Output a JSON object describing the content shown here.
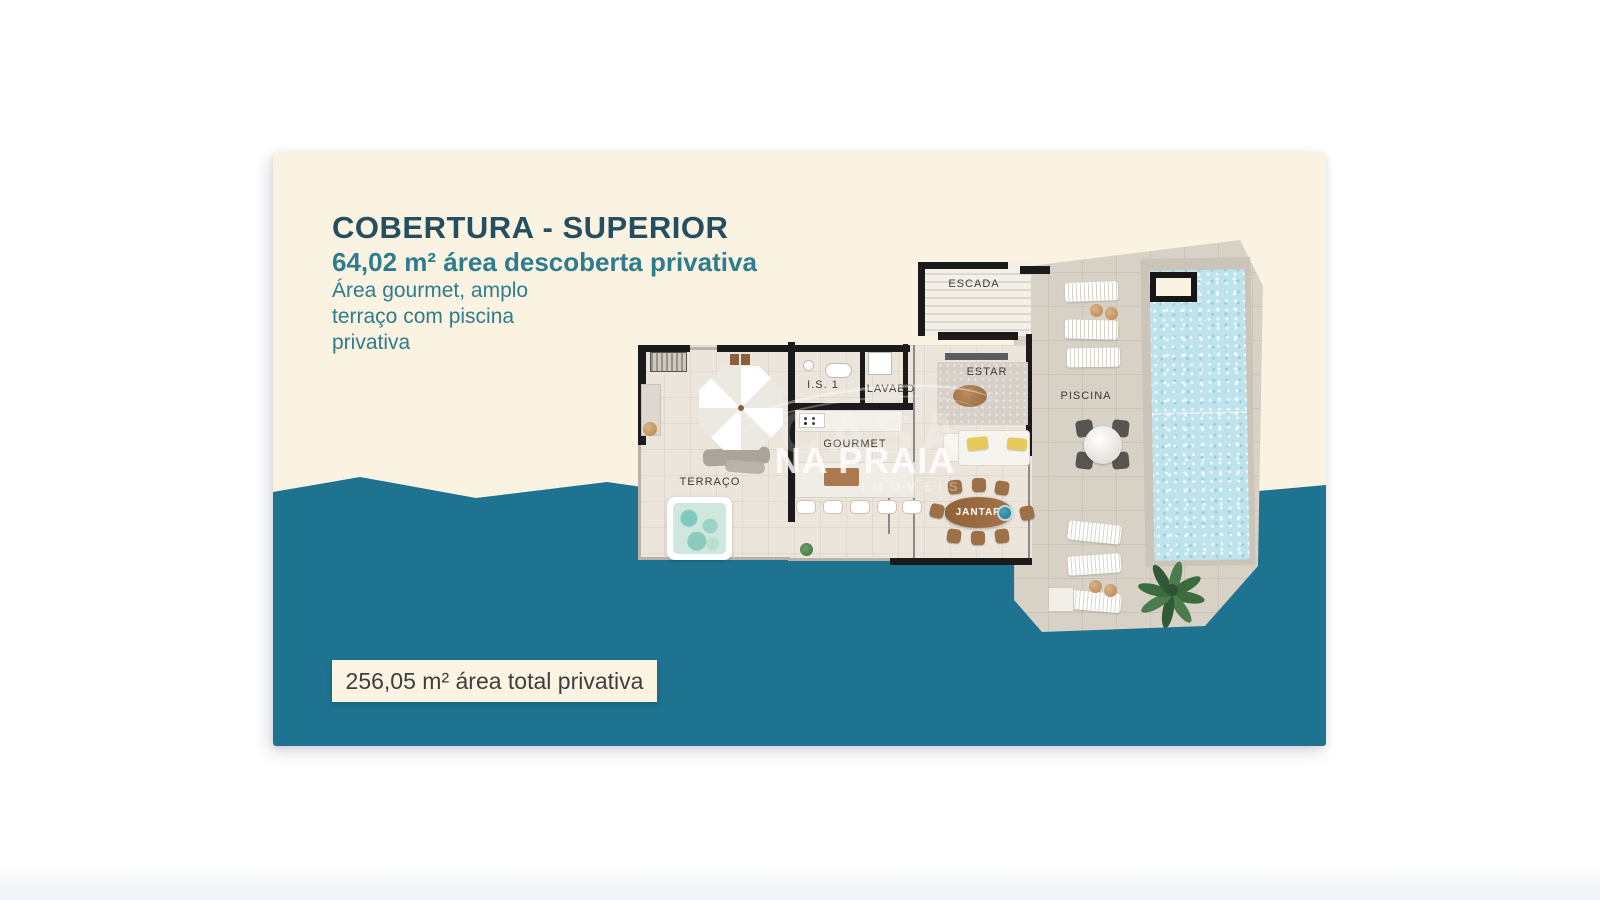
{
  "header": {
    "title": "COBERTURA - SUPERIOR",
    "subtitle": "64,02 m² área descoberta privativa",
    "description_lines": [
      "Área gourmet, amplo",
      "terraço com piscina",
      "privativa"
    ]
  },
  "footer": {
    "total_area": "256,05 m² área total privativa"
  },
  "floorplan": {
    "labels": {
      "escada": "ESCADA",
      "estar": "ESTAR",
      "is1": "I.S. 1",
      "lavabo": "LAVABO",
      "gourmet": "GOURMET",
      "terraco": "TERRAÇO",
      "jantar": "JANTAR",
      "piscina": "PISCINA"
    }
  },
  "watermark": {
    "line1": "CASA",
    "line2": "NA PRAIA",
    "line3": "IMÓVEIS"
  },
  "colors": {
    "teal_background": "#1D7390",
    "cream_background": "#FAF3E1",
    "title_text": "#254E60",
    "accent_text": "#2E7D8E",
    "pool_water": "#BFE3EC",
    "wall": "#1B1B1B"
  }
}
